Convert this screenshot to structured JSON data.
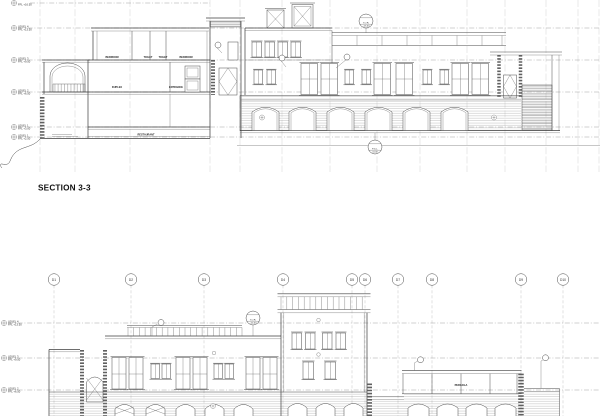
{
  "sheet": {
    "background": "#ffffff",
    "ink": "#3d3d3d"
  },
  "section": {
    "title": "SECTION 3-3",
    "top_partial_elev": "FFL +16.50",
    "levels": [
      {
        "name": "LEVEL 4",
        "elev": "FFL +13.50"
      },
      {
        "name": "LEVEL 3",
        "elev": "FFL +9.50"
      },
      {
        "name": "LEVEL 2",
        "elev": "FFL +6.50"
      },
      {
        "name": "LEVEL 1",
        "elev": "FFL +3.00"
      },
      {
        "name": "LEVEL 1",
        "elev": "FFL +2.50"
      }
    ],
    "rooms": {
      "bedroom_left": "BEDROOM",
      "toilet_left": "TOILET",
      "toilet_right": "TOILET",
      "bedroom_right": "BEDROOM",
      "duplex": "DUPLEX",
      "entrance": "ENTRANCE",
      "restaurant": "RESTAURANT"
    },
    "datums": {
      "roof": {
        "l1": "T.O.R.",
        "l2": "+15.00"
      },
      "ground": {
        "l1": "F.G.L.",
        "l2": "±0.00"
      }
    }
  },
  "elevation": {
    "grids": [
      "D1",
      "D2",
      "D3",
      "D4",
      "D5",
      "D6",
      "D7",
      "D8",
      "D9",
      "D10"
    ],
    "levels": [
      {
        "name": "LEVEL 4",
        "elev": "FFL +13.50"
      },
      {
        "name": "LEVEL 3",
        "elev": "FFL +9.50"
      },
      {
        "name": "LEVEL 2",
        "elev": "FFL +6.50"
      }
    ],
    "pergola_label": "PERGOLA",
    "datum": {
      "l1": "T.O.R.",
      "l2": "+14.00"
    }
  }
}
